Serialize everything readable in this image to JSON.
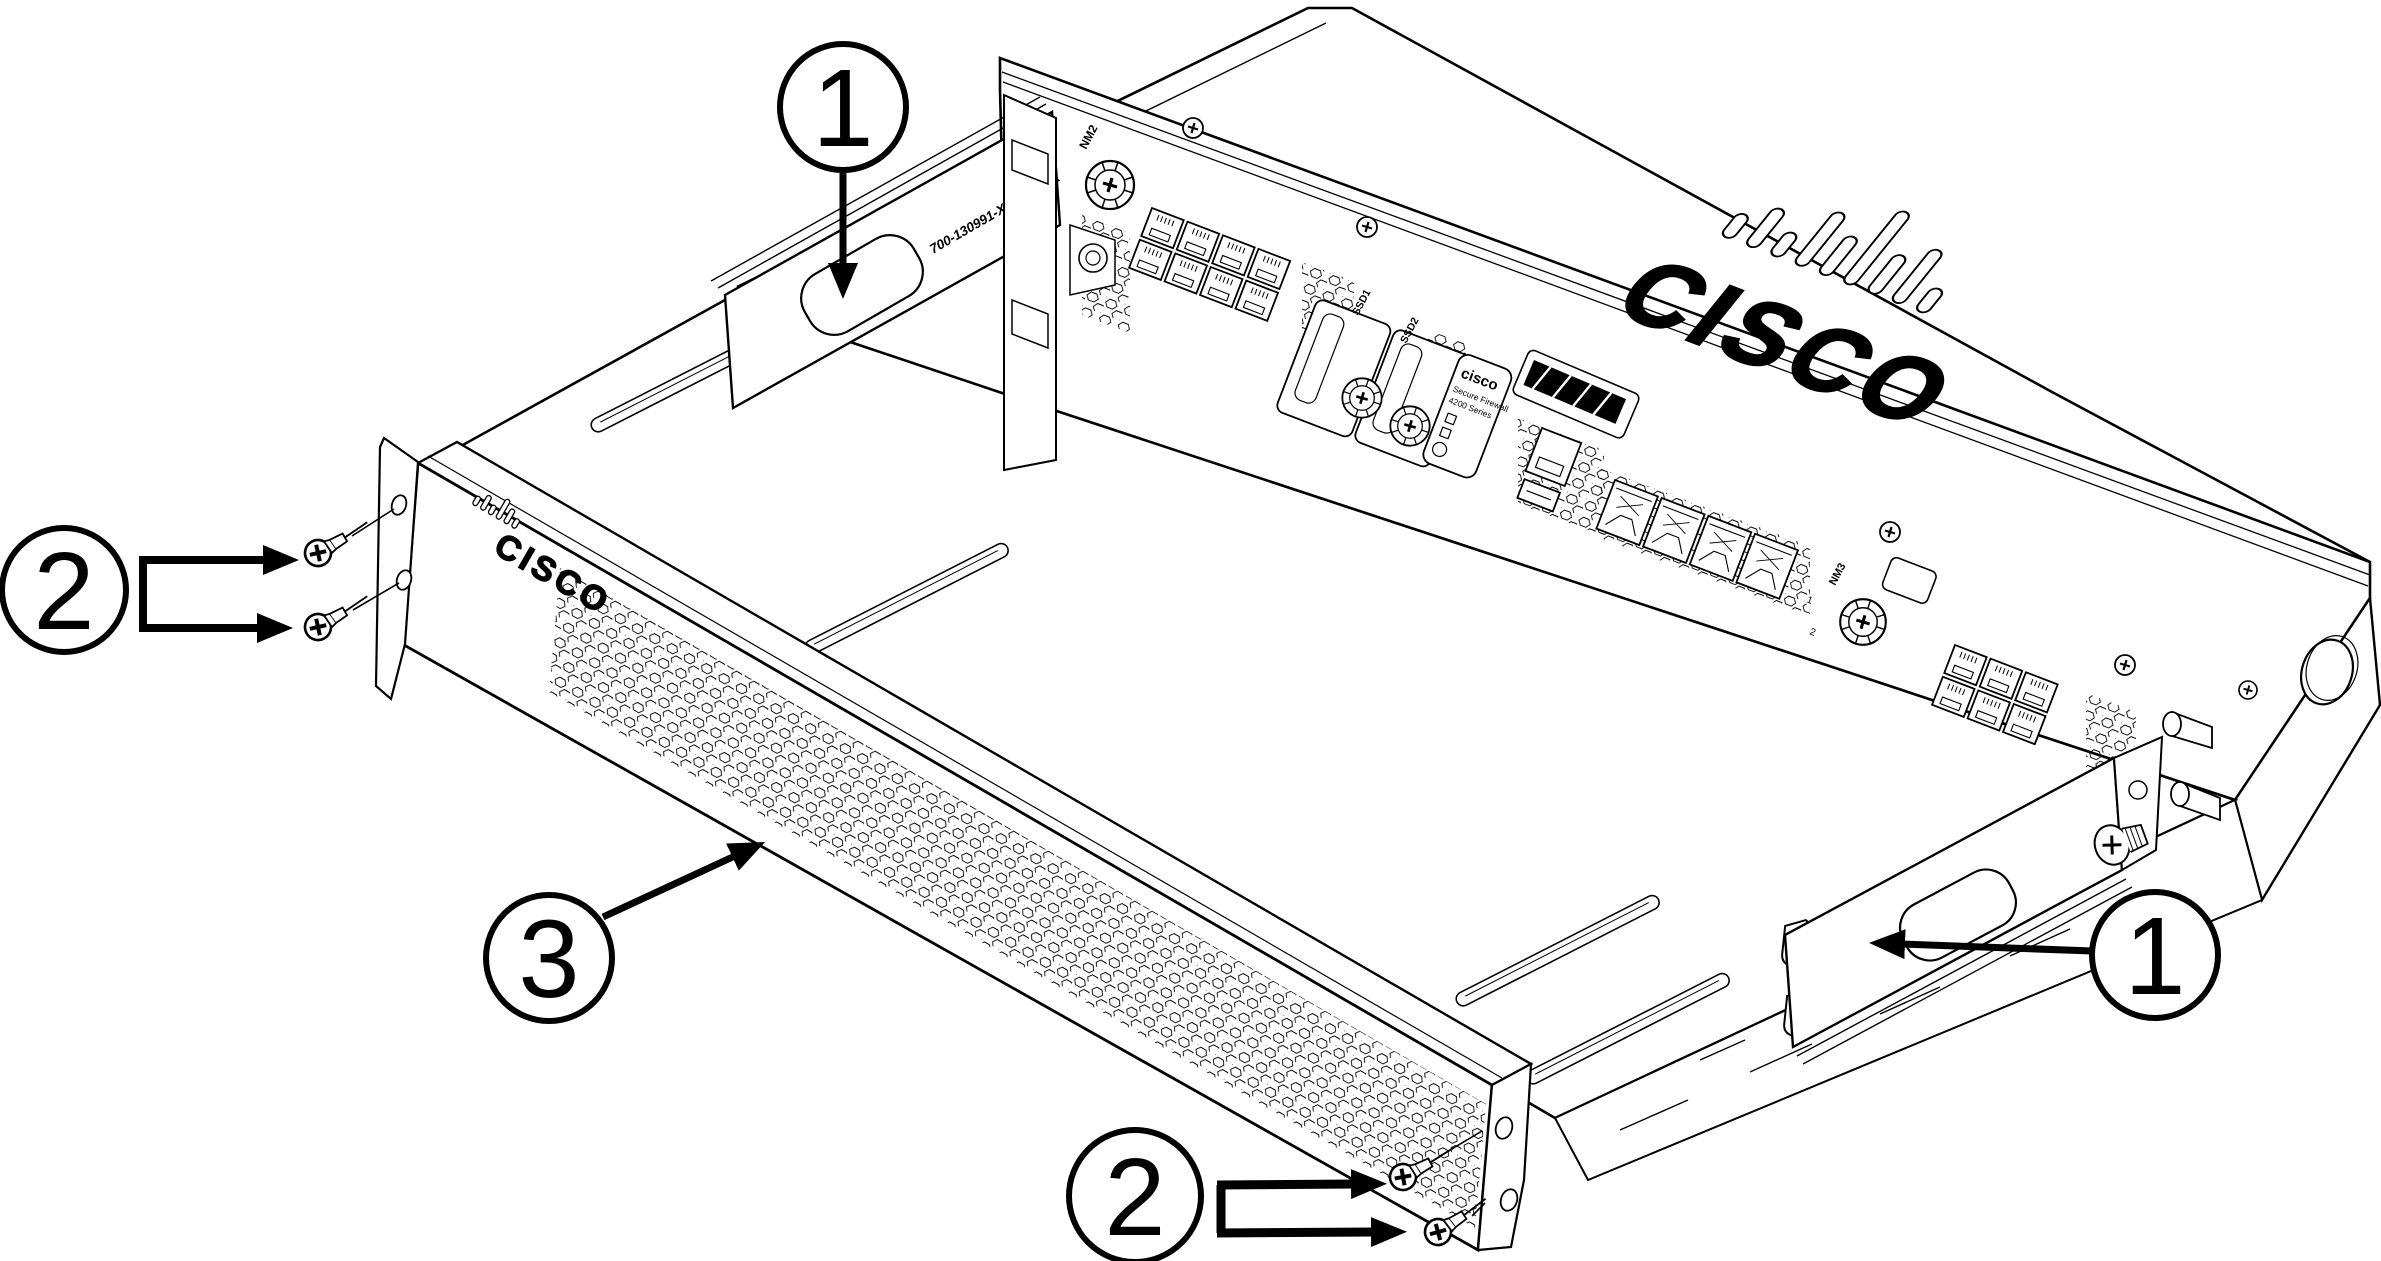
{
  "callouts": [
    {
      "id": "1-top",
      "label": "1"
    },
    {
      "id": "2-left",
      "label": "2"
    },
    {
      "id": "3-bezel",
      "label": "3"
    },
    {
      "id": "1-right",
      "label": "1"
    },
    {
      "id": "2-bottom",
      "label": "2"
    }
  ],
  "chassis": {
    "top_logo": "CISCO",
    "bracket_part_number": "700-130991-XX REV XX",
    "nm2_label": "NM2",
    "nm3_label": "NM3",
    "ssd1_label": "SSD1",
    "ssd2_label": "SSD2",
    "nm_slot1_label": "1",
    "nm_slot2_label": "2",
    "product_label": {
      "brand": "cisco",
      "line1": "Secure Firewall",
      "line2": "4200 Series"
    }
  },
  "bezel": {
    "logo": "CISCO"
  },
  "colors": {
    "line": "#000000",
    "background": "#ffffff"
  }
}
